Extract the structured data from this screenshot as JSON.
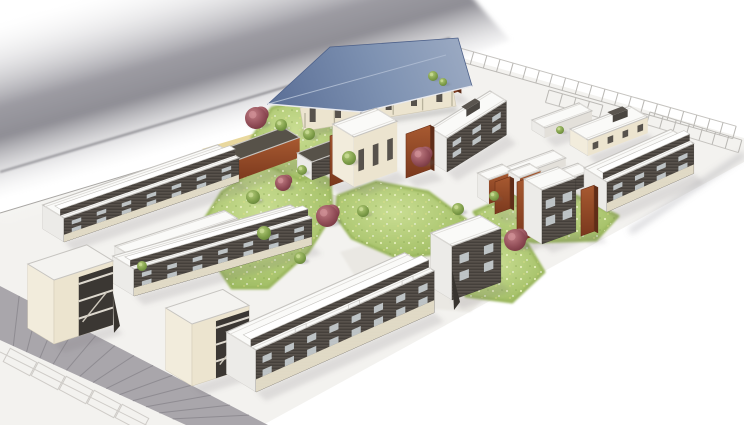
{
  "scene": {
    "title": "aerial-architectural-rendering-housing-complex",
    "canvas": {
      "w": 744,
      "h": 425,
      "background": "#ffffff"
    },
    "palette": {
      "ground": "#f3f2ef",
      "plaza": "#eae8e3",
      "path": "#dedbd4",
      "road_gray": "#8f8e95",
      "road_line_dark": "#6a6970",
      "road_line_light": "#a8a6a3",
      "cream_wall_fence": "#e9d89e",
      "parking_band": "#a9a6ab",
      "parking_tick": "#8f8c92",
      "stall_outline": "#cecbc7",
      "roof_white": "#fafaf8",
      "roof_edge": "#c6c4c0",
      "roof_dark": "#575249",
      "facade_louver": "#45403b",
      "louver_stripe": "#6e6861",
      "cream": "#ece4cf",
      "cream_side": "#f2ecdc",
      "window_dark": "#57524c",
      "window_light": "#cdd4d7",
      "rust_top": "#a85a31",
      "rust_bottom": "#7a381d",
      "rust_side": "#5f2d18",
      "canopy_light": "#9aa9c2",
      "canopy_mid": "#7e92b2",
      "canopy_dark": "#5d7198",
      "grass_light": "#cade93",
      "grass_mid": "#a9c46d",
      "grass_dark": "#7e9c4a",
      "tree_green_hi": "#b4cc79",
      "tree_green_lo": "#5c7c34",
      "tree_red_hi": "#c27f85",
      "tree_red_lo": "#6d2f38",
      "shadow": "rgba(120,118,124,0.18)"
    },
    "road_band": {
      "quad": [
        [
          -20,
          0
        ],
        [
          430,
          -50
        ],
        [
          510,
          40
        ],
        [
          10,
          225
        ],
        [
          -20,
          215
        ]
      ],
      "center_line": [
        [
          0,
          172
        ],
        [
          450,
          38
        ]
      ],
      "edge_line": [
        [
          0,
          213
        ],
        [
          447,
          79
        ]
      ],
      "fence_wall": [
        [
          203,
          151
        ],
        [
          447,
          79
        ]
      ]
    },
    "site_polygon": [
      [
        0,
        213
      ],
      [
        203,
        152
      ],
      [
        447,
        79
      ],
      [
        456,
        56
      ],
      [
        744,
        138
      ],
      [
        744,
        162
      ],
      [
        263,
        425
      ],
      [
        0,
        425
      ]
    ],
    "site_edge_shadow": [
      [
        630,
        232
      ],
      [
        744,
        154
      ]
    ],
    "parking_top": {
      "rows": [
        {
          "x": 444,
          "y": 57,
          "angle": 15.8,
          "len": 300,
          "count": 22,
          "tick": [
            3.5,
            -12.5
          ],
          "edges": true
        },
        {
          "x": 549,
          "y": 90,
          "angle": 15.8,
          "len": 56,
          "count": 4,
          "tick": [
            -3.5,
            12.5
          ],
          "edges": true
        },
        {
          "x": 650,
          "y": 112,
          "angle": 17,
          "len": 96,
          "count": 7,
          "tick": [
            -3.5,
            12.5
          ],
          "edges": true
        }
      ],
      "drive_lines": [
        [
          [
            424,
            68
          ],
          [
            444,
            97
          ]
        ],
        [
          [
            438,
            62
          ],
          [
            458,
            91
          ]
        ]
      ]
    },
    "parking_bottom": {
      "band": [
        [
          0,
          286
        ],
        [
          268,
          425
        ],
        [
          186,
          425
        ],
        [
          0,
          340
        ]
      ],
      "tick_count": 14,
      "stall_outlines": {
        "centers": [
          [
            20,
            362
          ],
          [
            48,
            376
          ],
          [
            76,
            390
          ],
          [
            104,
            404
          ],
          [
            132,
            418
          ]
        ],
        "w": 30,
        "h": 15,
        "angle": 28
      },
      "curb": [
        [
          0,
          352
        ],
        [
          168,
          436
        ]
      ]
    },
    "plaza": [
      [
        340,
        252
      ],
      [
        452,
        218
      ],
      [
        540,
        246
      ],
      [
        470,
        312
      ],
      [
        372,
        304
      ]
    ],
    "paths": [
      "M 333,125 Q 310,165 288,195 Q 262,228 230,250",
      "M 292,187 Q 350,210 420,222 Q 472,228 505,224",
      "M 420,222 Q 408,255 385,278"
    ],
    "grass": [
      [
        [
          212,
          258
        ],
        [
          203,
          222
        ],
        [
          222,
          192
        ],
        [
          258,
          168
        ],
        [
          300,
          162
        ],
        [
          330,
          180
        ],
        [
          332,
          214
        ],
        [
          308,
          252
        ],
        [
          268,
          288
        ],
        [
          232,
          288
        ]
      ],
      [
        [
          338,
          196
        ],
        [
          376,
          182
        ],
        [
          428,
          192
        ],
        [
          466,
          220
        ],
        [
          448,
          252
        ],
        [
          398,
          258
        ],
        [
          352,
          238
        ],
        [
          336,
          216
        ]
      ],
      [
        [
          252,
          138
        ],
        [
          272,
          108
        ],
        [
          304,
          98
        ],
        [
          336,
          112
        ],
        [
          352,
          142
        ],
        [
          340,
          168
        ],
        [
          300,
          180
        ],
        [
          264,
          164
        ]
      ],
      [
        [
          474,
          212
        ],
        [
          520,
          192
        ],
        [
          576,
          196
        ],
        [
          618,
          216
        ],
        [
          596,
          240
        ],
        [
          534,
          242
        ],
        [
          492,
          234
        ]
      ],
      [
        [
          452,
          262
        ],
        [
          484,
          238
        ],
        [
          526,
          242
        ],
        [
          544,
          272
        ],
        [
          512,
          302
        ],
        [
          466,
          296
        ]
      ]
    ],
    "community_building": {
      "canopy": [
        [
          268,
          104
        ],
        [
          330,
          47
        ],
        [
          458,
          38
        ],
        [
          472,
          86
        ],
        [
          362,
          112
        ]
      ],
      "ridge": [
        [
          268,
          104
        ],
        [
          446,
          55
        ]
      ],
      "base": [
        [
          300,
          108
        ],
        [
          452,
          84
        ],
        [
          456,
          106
        ],
        [
          304,
          131
        ]
      ],
      "base_shadow": [
        [
          300,
          131
        ],
        [
          456,
          106
        ],
        [
          458,
          112
        ],
        [
          302,
          137
        ]
      ],
      "columns": 6,
      "column_line": [
        [
          305,
          128
        ],
        [
          452,
          106
        ]
      ],
      "openings": 6
    },
    "buildings": [
      {
        "name": "corten-fin-north",
        "kind": "fin",
        "x": 448,
        "y": 95,
        "len": 10,
        "h": 32
      },
      {
        "name": "community-building",
        "kind": "community"
      },
      {
        "name": "low-bar-northeast",
        "kind": "bar",
        "x": 545,
        "y": 138,
        "angle": -20,
        "len": 50,
        "dep": 16,
        "h": 10,
        "facade": "plain"
      },
      {
        "name": "cream-building-northeast",
        "kind": "bar",
        "x": 588,
        "y": 156,
        "angle": -21,
        "len": 64,
        "dep": 22,
        "h": 16,
        "facade": "cream",
        "windows": "dark",
        "roofBox": {
          "t": 0.55,
          "dark": true
        }
      },
      {
        "name": "bar-center-north",
        "kind": "bar",
        "x": 447,
        "y": 172,
        "angle": -32,
        "len": 70,
        "dep": 20,
        "h": 34,
        "facade": "louver",
        "windows": "light",
        "roofBox": {
          "t": 0.45,
          "dark": true
        }
      },
      {
        "name": "pergola-shed-northwest",
        "kind": "bar",
        "x": 232,
        "y": 182,
        "angle": -20,
        "len": 72,
        "dep": 20,
        "h": 20,
        "facade": "rust",
        "roof": "dark"
      },
      {
        "name": "slat-shed-north",
        "kind": "bar",
        "x": 312,
        "y": 180,
        "angle": -20,
        "len": 42,
        "dep": 18,
        "h": 18,
        "facade": "louver",
        "roof": "dark"
      },
      {
        "name": "corten-fin-center-left",
        "kind": "fin",
        "x": 330,
        "y": 186,
        "len": 22,
        "h": 50
      },
      {
        "name": "center-three-story",
        "kind": "bar",
        "x": 354,
        "y": 187,
        "angle": -20,
        "len": 46,
        "dep": 26,
        "h": 50,
        "facade": "cream",
        "windows": "dark"
      },
      {
        "name": "corten-fin-center-right",
        "kind": "fin",
        "x": 406,
        "y": 178,
        "len": 26,
        "h": 44
      },
      {
        "name": "canopy-row-east",
        "kind": "bar",
        "x": 500,
        "y": 190,
        "angle": -20,
        "len": 70,
        "dep": 16,
        "h": 8,
        "facade": "plain"
      },
      {
        "name": "rust-shed-a",
        "kind": "bar",
        "x": 489,
        "y": 204,
        "angle": -20,
        "len": 26,
        "dep": 14,
        "h": 24,
        "facade": "rust"
      },
      {
        "name": "rust-shed-b",
        "kind": "bar",
        "x": 520,
        "y": 198,
        "angle": -20,
        "len": 22,
        "dep": 14,
        "h": 20,
        "facade": "rust"
      },
      {
        "name": "low-dark-bar-east",
        "kind": "bar",
        "x": 542,
        "y": 202,
        "angle": -20,
        "len": 52,
        "dep": 16,
        "h": 13,
        "facade": "louver"
      },
      {
        "name": "corten-wall-east",
        "kind": "fin",
        "x": 495,
        "y": 214,
        "len": 16,
        "h": 32
      },
      {
        "name": "bar-east",
        "kind": "bar",
        "x": 607,
        "y": 212,
        "angle": -24,
        "len": 95,
        "dep": 28,
        "h": 30,
        "facade": "louver",
        "base": true,
        "clere": true,
        "windows": "light"
      },
      {
        "name": "bar-northwest",
        "kind": "bar",
        "x": 64,
        "y": 242,
        "angle": -19,
        "len": 185,
        "dep": 26,
        "h": 24,
        "facade": "louver",
        "base": true,
        "clere": true,
        "windows": "light"
      },
      {
        "name": "garage-row-northwest",
        "kind": "bar",
        "x": 128,
        "y": 264,
        "angle": -18,
        "len": 115,
        "dep": 16,
        "h": 10,
        "facade": "plain"
      },
      {
        "name": "corten-fin-courtyard-east",
        "kind": "fin",
        "x": 517,
        "y": 242,
        "len": 22,
        "h": 60
      },
      {
        "name": "dark-cube-east",
        "kind": "bar",
        "x": 542,
        "y": 244,
        "angle": -20,
        "len": 36,
        "dep": 22,
        "h": 54,
        "facade": "louver",
        "windows": "light"
      },
      {
        "name": "corten-fin-east-b",
        "kind": "fin",
        "x": 581,
        "y": 236,
        "len": 14,
        "h": 46
      },
      {
        "name": "bar-west",
        "kind": "bar",
        "x": 134,
        "y": 296,
        "angle": -16,
        "len": 185,
        "dep": 26,
        "h": 27,
        "facade": "louver",
        "base": true,
        "clere": true,
        "windows": "light"
      },
      {
        "name": "dark-cube-southeast",
        "kind": "bar",
        "x": 452,
        "y": 300,
        "angle": -20,
        "len": 52,
        "dep": 26,
        "h": 54,
        "facade": "louver",
        "windows": "light",
        "blade": true
      },
      {
        "name": "stair-tower-west",
        "kind": "tower",
        "x": 54,
        "y": 344,
        "angle": -18,
        "len": 62,
        "dep": 32,
        "h": 64
      },
      {
        "name": "stair-tower-south",
        "kind": "tower",
        "x": 192,
        "y": 386,
        "angle": -18,
        "len": 60,
        "dep": 32,
        "h": 62
      },
      {
        "name": "bar-south",
        "kind": "bar",
        "x": 256,
        "y": 392,
        "angle": -24,
        "len": 195,
        "dep": 36,
        "h": 42,
        "facade": "louver",
        "base": true,
        "clere": true,
        "windows": "light",
        "entries": [
          0.22,
          0.52,
          0.82
        ]
      }
    ],
    "trees": [
      {
        "type": "red",
        "x": 256,
        "y": 118,
        "r": 11
      },
      {
        "type": "red",
        "x": 283,
        "y": 183,
        "r": 8
      },
      {
        "type": "red",
        "x": 327,
        "y": 216,
        "r": 11
      },
      {
        "type": "red",
        "x": 421,
        "y": 157,
        "r": 10
      },
      {
        "type": "red",
        "x": 515,
        "y": 240,
        "r": 11
      },
      {
        "type": "green",
        "x": 281,
        "y": 125,
        "r": 6
      },
      {
        "type": "green",
        "x": 309,
        "y": 134,
        "r": 6
      },
      {
        "type": "green",
        "x": 349,
        "y": 158,
        "r": 7
      },
      {
        "type": "green",
        "x": 363,
        "y": 211,
        "r": 6
      },
      {
        "type": "green",
        "x": 253,
        "y": 197,
        "r": 7
      },
      {
        "type": "green",
        "x": 264,
        "y": 233,
        "r": 7
      },
      {
        "type": "green",
        "x": 300,
        "y": 258,
        "r": 6
      },
      {
        "type": "green",
        "x": 302,
        "y": 170,
        "r": 5
      },
      {
        "type": "green",
        "x": 433,
        "y": 76,
        "r": 5
      },
      {
        "type": "green",
        "x": 443,
        "y": 82,
        "r": 4
      },
      {
        "type": "green",
        "x": 458,
        "y": 209,
        "r": 6
      },
      {
        "type": "green",
        "x": 494,
        "y": 196,
        "r": 5
      },
      {
        "type": "green",
        "x": 142,
        "y": 266,
        "r": 5
      },
      {
        "type": "green",
        "x": 560,
        "y": 130,
        "r": 4
      }
    ]
  }
}
